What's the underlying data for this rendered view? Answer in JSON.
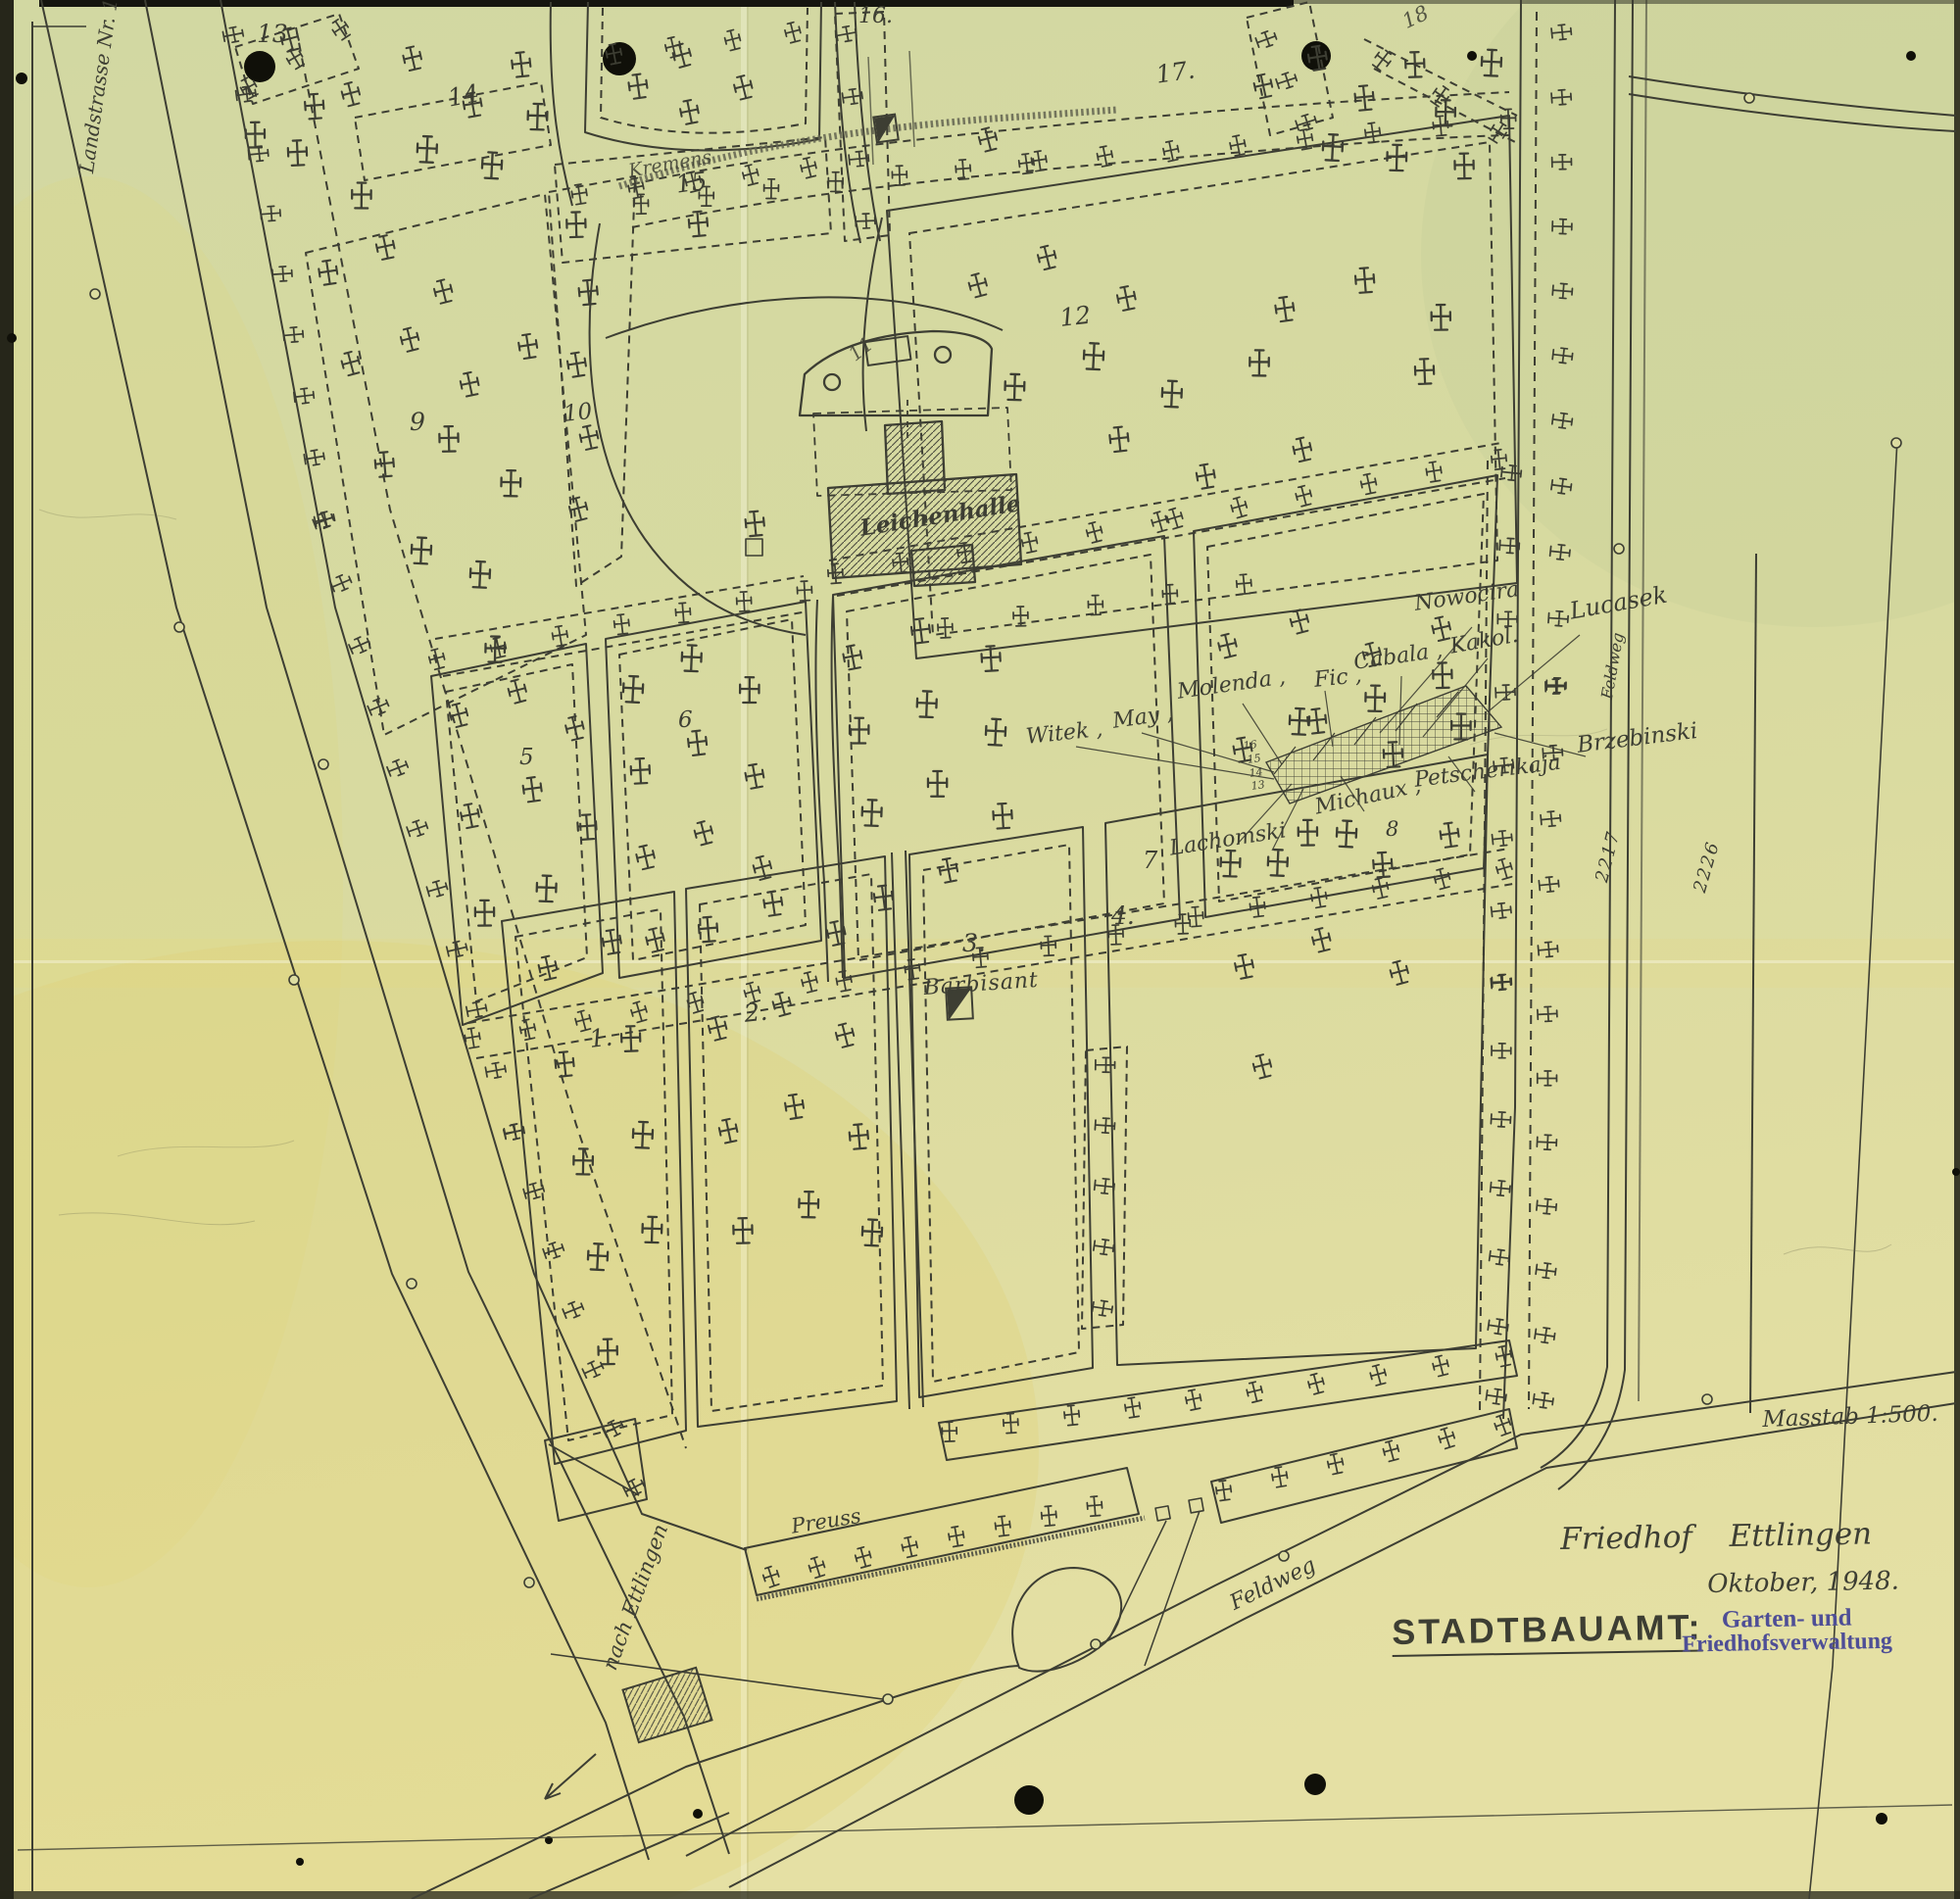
{
  "title_block": {
    "map_title": "Friedhof Ettlingen",
    "date": "Oktober, 1948.",
    "office": "STADTBAUAMT:",
    "stamp_line1": "Garten- und",
    "stamp_line2": "Friedhofsverwaltung",
    "scale": "Masstab 1:500."
  },
  "roads": {
    "landstrasse": "Landstrasse Nr. 1",
    "nach_ettlingen": "nach Ettlingen",
    "feldweg_bottom": "Feldweg",
    "feldweg_right": "Feldweg"
  },
  "features": {
    "morgue": "Leichenhalle",
    "kremens": "Kremens",
    "preuss": "Preuss",
    "barbisant": "Barbisant"
  },
  "plot_numbers": {
    "p1": "1.",
    "p2": "2.",
    "p3": "3.",
    "p4": "4.",
    "p5": "5",
    "p6": "6",
    "p7": "7",
    "p8": "8",
    "p9": "9",
    "p10": "10",
    "p11": "11",
    "p12": "12",
    "p13": "13",
    "p14": "14",
    "p15": "15",
    "p16": "16.",
    "p17": "17.",
    "p18": "18"
  },
  "parcel_numbers": {
    "left": "2217",
    "right": "2226"
  },
  "grave_names": {
    "witek": "Witek ,",
    "may": "May ,",
    "molenda": "Molenda ,",
    "fic": "Fic ,",
    "cabala": "Cabala ,",
    "kakol": "Kakol.",
    "nowocira": "Nowocira",
    "lucasek": "Lucasek",
    "brzebinski": "Brzebinski",
    "lachomski": "Lachomski",
    "michaux": "Michaux ,",
    "petscherikaja": "Petscherikaja"
  },
  "grave_row_numbers": [
    "16",
    "15",
    "14",
    "13"
  ],
  "ink": {
    "line_color": "#3d3e33",
    "stamp_color": "#4e4e96"
  }
}
